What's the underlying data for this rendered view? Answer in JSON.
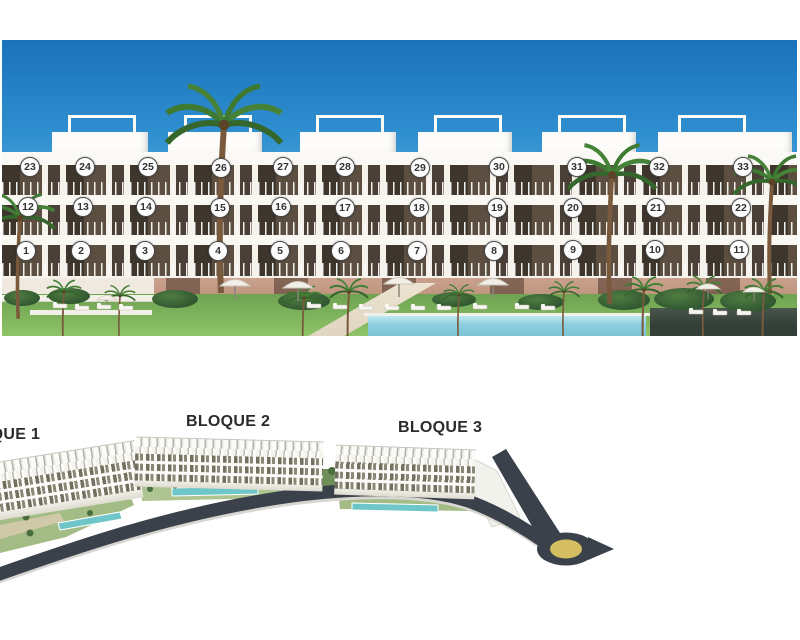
{
  "colors": {
    "circle-border": "#4b4b4b",
    "circle-text": "#333333",
    "label-text": "#2b2b2b",
    "road": "#3a414a",
    "roundabout-center": "#d5bd62",
    "site-pool": "#6fc6c9",
    "facade-pool": "#8ed0e0",
    "sky-top": "#1b72ba",
    "grass": "#7fb45d"
  },
  "facade_view": {
    "floors": {
      "floor3": [
        "23",
        "24",
        "25",
        "26",
        "27",
        "28",
        "29",
        "30",
        "31",
        "32",
        "33"
      ],
      "floor2": [
        "12",
        "13",
        "14",
        "15",
        "16",
        "17",
        "18",
        "19",
        "20",
        "21",
        "22"
      ],
      "floor1": [
        "1",
        "2",
        "3",
        "4",
        "5",
        "6",
        "7",
        "8",
        "9",
        "10",
        "11"
      ]
    }
  },
  "site_plan": {
    "blocks": [
      {
        "label": "BLOQUE 1"
      },
      {
        "label": "BLOQUE 2"
      },
      {
        "label": "BLOQUE 3"
      }
    ]
  }
}
